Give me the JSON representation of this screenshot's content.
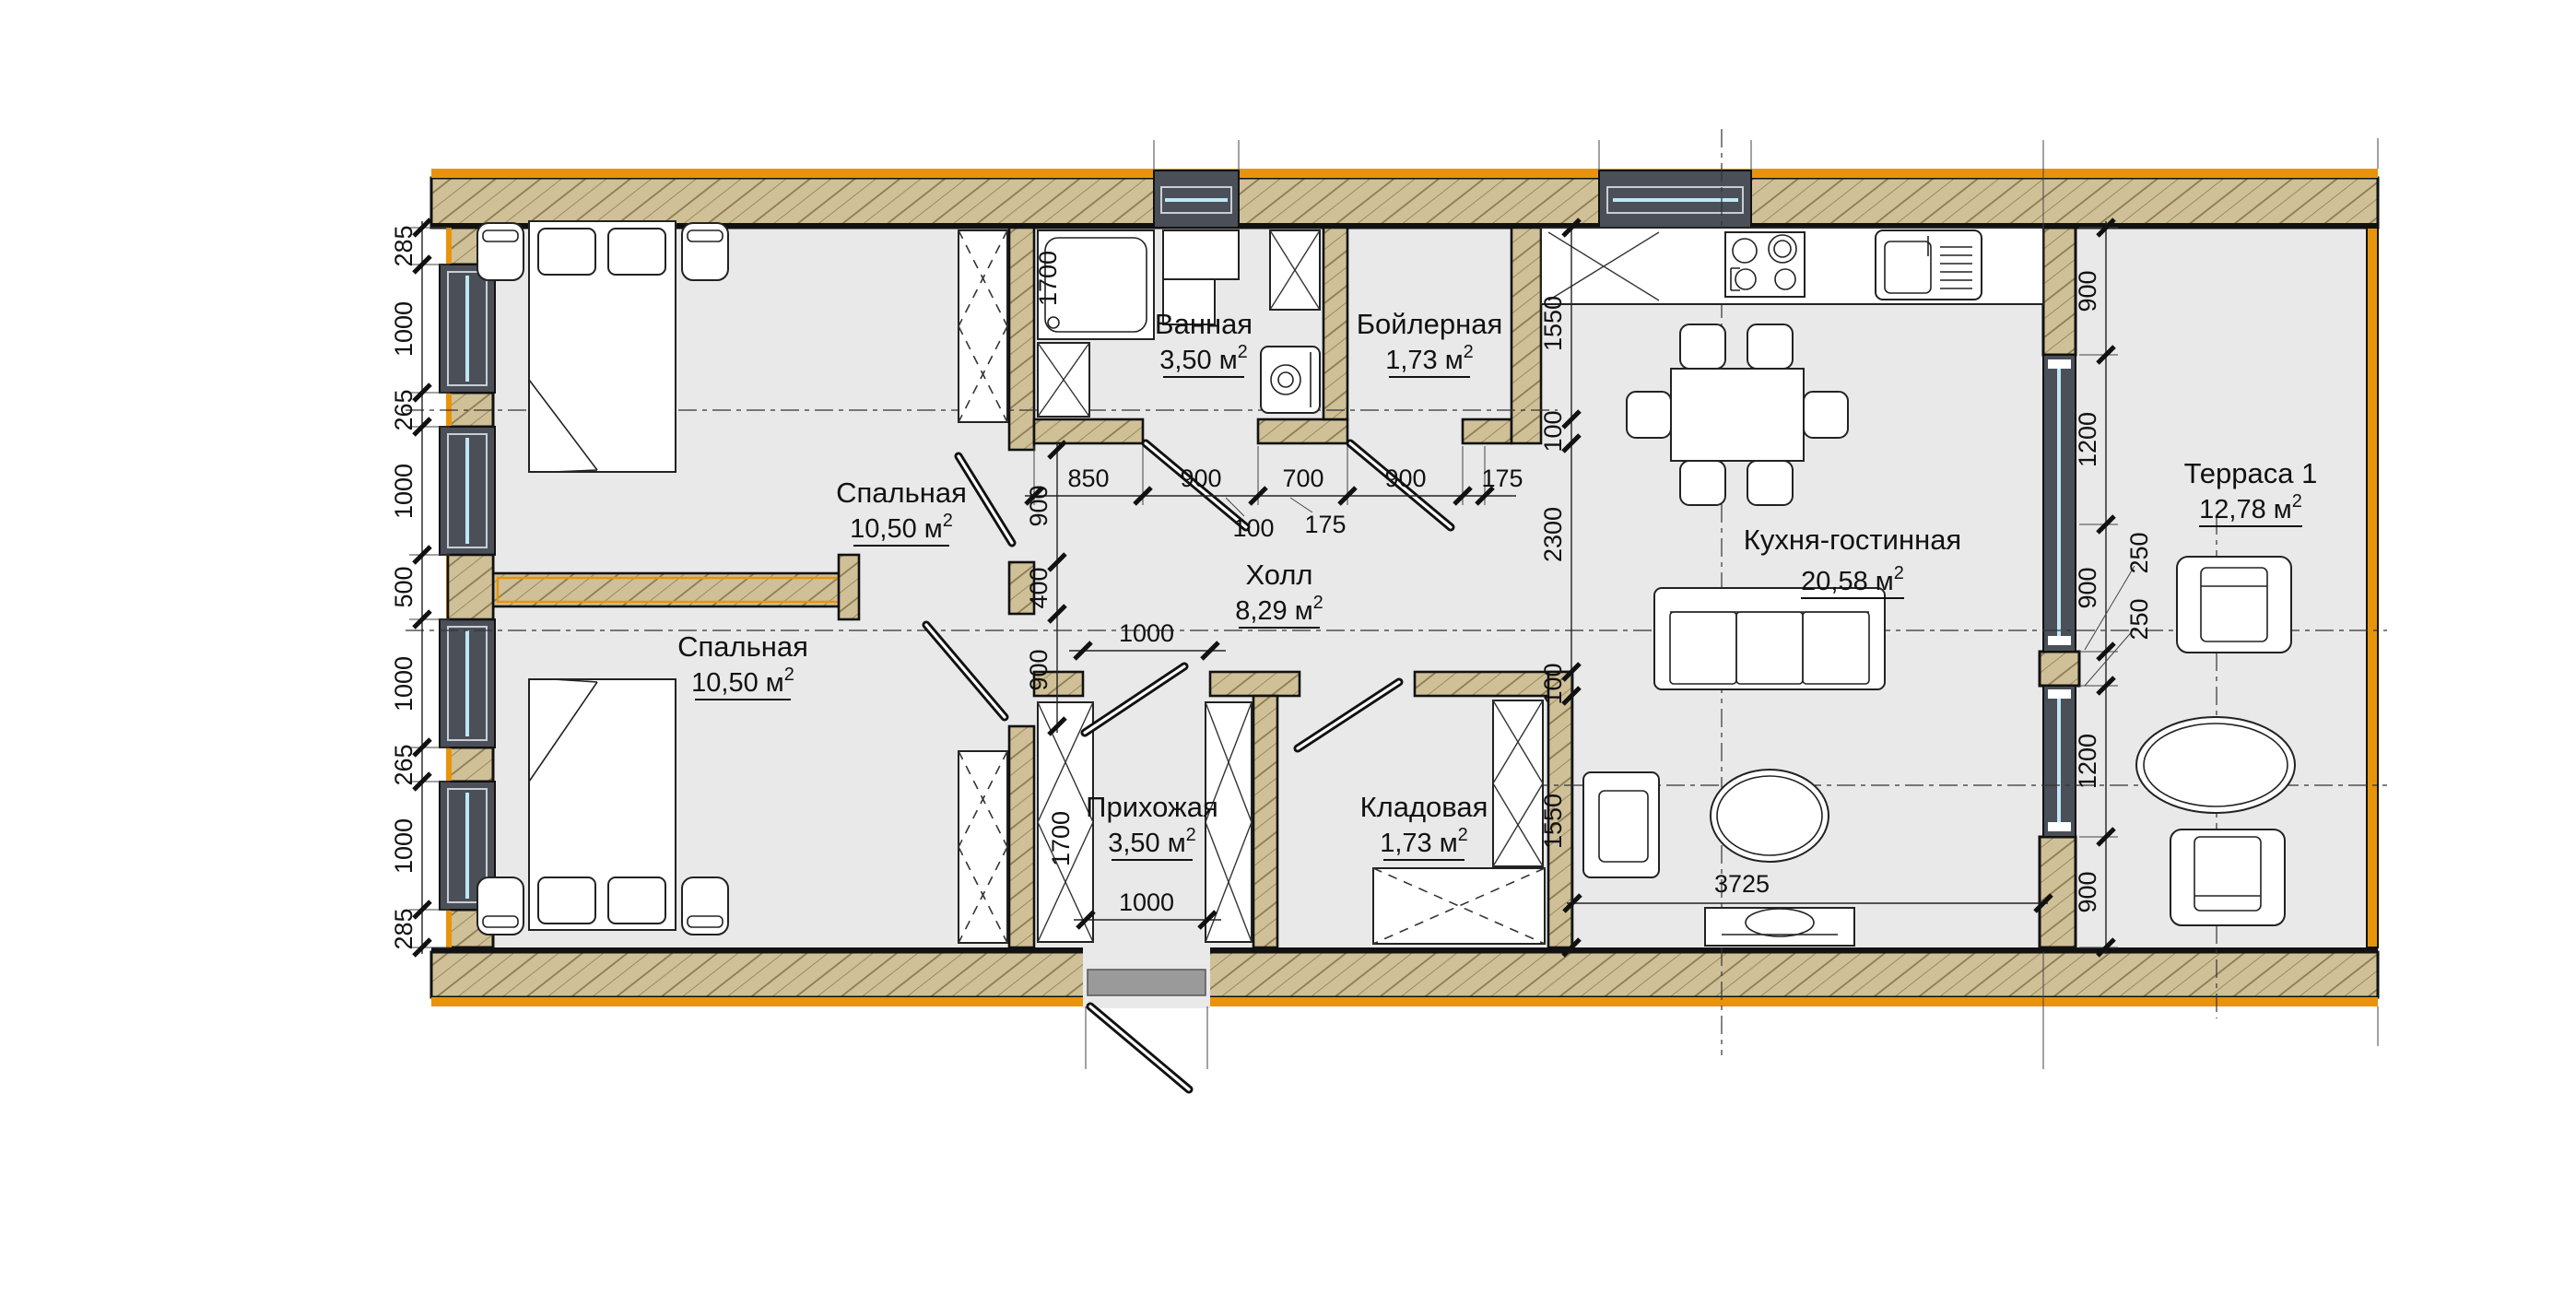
{
  "drawing": {
    "type": "architectural-floor-plan",
    "rooms": [
      {
        "id": "bedroom-1",
        "name": "Спальная",
        "area": "10,50 м",
        "sup": "2"
      },
      {
        "id": "bedroom-2",
        "name": "Спальная",
        "area": "10,50 м",
        "sup": "2"
      },
      {
        "id": "bathroom",
        "name": "Ванная",
        "area": "3,50 м",
        "sup": "2"
      },
      {
        "id": "boiler",
        "name": "Бойлерная",
        "area": "1,73 м",
        "sup": "2"
      },
      {
        "id": "hall",
        "name": "Холл",
        "area": "8,29 м",
        "sup": "2"
      },
      {
        "id": "entry",
        "name": "Прихожая",
        "area": "3,50 м",
        "sup": "2"
      },
      {
        "id": "storage",
        "name": "Кладовая",
        "area": "1,73 м",
        "sup": "2"
      },
      {
        "id": "kitchen",
        "name": "Кухня-гостинная",
        "area": "20,58 м",
        "sup": "2"
      },
      {
        "id": "terrace",
        "name": "Терраса 1",
        "area": "12,78 м",
        "sup": "2"
      }
    ],
    "dims": {
      "left": [
        "285",
        "1000",
        "265",
        "1000",
        "500",
        "1000",
        "265",
        "1000",
        "285"
      ],
      "right": [
        "900",
        "1200",
        "900",
        "1200",
        "900"
      ],
      "right_callouts": [
        "250",
        "250"
      ],
      "top_row": [
        "850",
        "900",
        "700",
        "900",
        "175"
      ],
      "top_callouts": [
        "100",
        "175"
      ],
      "bed_chain": [
        "900",
        "400",
        "900"
      ],
      "kitchen_chain": [
        "1550",
        "100",
        "2300",
        "100",
        "1550"
      ],
      "bath_tub": "1700",
      "wardrobe": "1700",
      "hall_door": "1000",
      "entry_door": "1000",
      "living_width": "3725"
    },
    "colors": {
      "wall_fill": "#cfc098",
      "wall_accent": "#e8940a",
      "window_dark": "#4b4f58",
      "glass": "#bfe7f5",
      "floor": "#e9e9e9"
    }
  }
}
